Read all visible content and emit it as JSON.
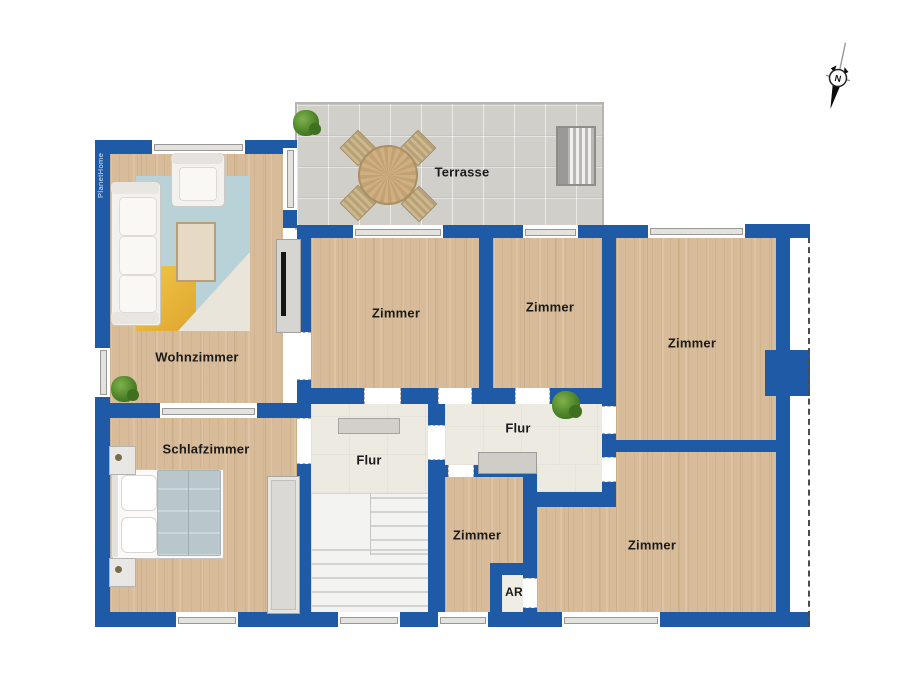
{
  "plan": {
    "watermark": "PlanetHome",
    "compass_label": "N",
    "colors": {
      "wall": "#1e5aa5",
      "wood_floor": "#d8bc99",
      "terrace_floor": "#d1cfca",
      "hallway_floor": "#edeae1",
      "stairs_floor": "#f3f3f1",
      "rug_blue": "#b9d2d8",
      "rug_yellow": "#edbf3c",
      "label_text": "#1b1b1b"
    },
    "rooms": [
      {
        "id": "terrasse",
        "label": "Terrasse"
      },
      {
        "id": "wohnzimmer",
        "label": "Wohnzimmer"
      },
      {
        "id": "zimmer-top-left",
        "label": "Zimmer"
      },
      {
        "id": "zimmer-top-middle",
        "label": "Zimmer"
      },
      {
        "id": "zimmer-right",
        "label": "Zimmer"
      },
      {
        "id": "schlafzimmer",
        "label": "Schlafzimmer"
      },
      {
        "id": "flur-left",
        "label": "Flur"
      },
      {
        "id": "flur-right",
        "label": "Flur"
      },
      {
        "id": "zimmer-bottom-middle",
        "label": "Zimmer"
      },
      {
        "id": "zimmer-bottom-right",
        "label": "Zimmer"
      },
      {
        "id": "abstellraum",
        "label": "AR"
      }
    ]
  }
}
